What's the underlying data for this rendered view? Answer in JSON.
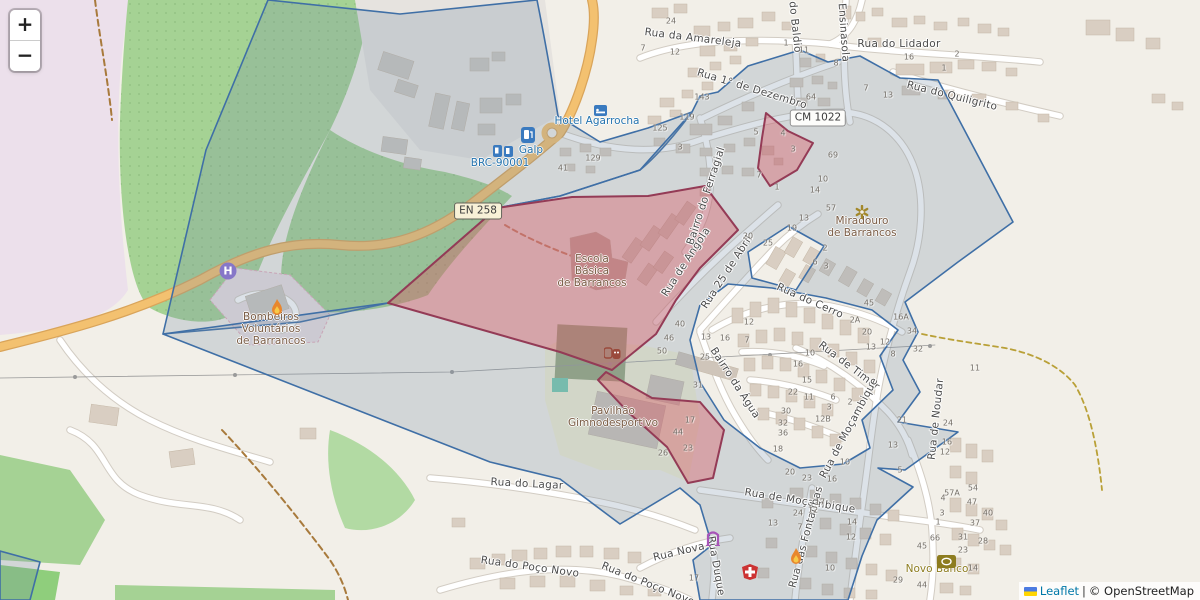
{
  "map": {
    "controls": {
      "zoom_in_label": "+",
      "zoom_out_label": "−"
    },
    "attribution": {
      "leaflet_label": "Leaflet",
      "separator": "|",
      "osm_label": "© OpenStreetMap"
    },
    "road_refs": {
      "en258": "EN 258",
      "cm1022": "CM 1022"
    },
    "icons": {
      "helipad_letter": "H"
    },
    "street_labels": [
      {
        "t": "Rua da Amareleja",
        "x": 693,
        "y": 38,
        "r": 7
      },
      {
        "t": "do Baldio",
        "x": 795,
        "y": 27,
        "r": 84
      },
      {
        "t": "de Ensinasola",
        "x": 843,
        "y": 24,
        "r": 86
      },
      {
        "t": "Rua do Lidador",
        "x": 899,
        "y": 44,
        "r": 0
      },
      {
        "t": "Rua do Quiligrito",
        "x": 952,
        "y": 96,
        "r": 14
      },
      {
        "t": "Rua 1° de Dezembro",
        "x": 752,
        "y": 89,
        "r": 17
      },
      {
        "t": "Bairro do Ferragial",
        "x": 706,
        "y": 196,
        "r": -72
      },
      {
        "t": "Rua de Angola",
        "x": 686,
        "y": 262,
        "r": -57
      },
      {
        "t": "Rua 25 de Abril",
        "x": 727,
        "y": 272,
        "r": -57
      },
      {
        "t": "Rua do Cerro",
        "x": 810,
        "y": 301,
        "r": 24
      },
      {
        "t": "Rua de Timor",
        "x": 849,
        "y": 366,
        "r": 37
      },
      {
        "t": "Bairro da Água",
        "x": 735,
        "y": 383,
        "r": 57
      },
      {
        "t": "Rua de Moçambique",
        "x": 849,
        "y": 428,
        "r": -62
      },
      {
        "t": "Rua de Noudar",
        "x": 936,
        "y": 419,
        "r": -84
      },
      {
        "t": "Rua do Lagar",
        "x": 527,
        "y": 484,
        "r": 3
      },
      {
        "t": "Rua de Moçambique",
        "x": 800,
        "y": 501,
        "r": 9
      },
      {
        "t": "Rua Nova",
        "x": 679,
        "y": 552,
        "r": -13
      },
      {
        "t": "Rua Duque",
        "x": 716,
        "y": 566,
        "r": 80
      },
      {
        "t": "Rua do Poço Novo",
        "x": 530,
        "y": 567,
        "r": 8
      },
      {
        "t": "Rua do Poço Novo",
        "x": 648,
        "y": 584,
        "r": 22
      },
      {
        "t": "Rua das Fontanhas",
        "x": 806,
        "y": 537,
        "r": -75
      }
    ],
    "poi_labels": [
      {
        "t": "Hotel Agarrocha",
        "x": 597,
        "y": 121,
        "cls": "blue"
      },
      {
        "t": "Galp",
        "x": 531,
        "y": 150,
        "cls": "blue"
      },
      {
        "t": "BRC-90001",
        "x": 500,
        "y": 163,
        "cls": "blue"
      },
      {
        "t": "Escola\nBásica\nde Barrancos",
        "x": 592,
        "y": 271,
        "cls": "brown"
      },
      {
        "t": "Miradouro\nde Barrancos",
        "x": 862,
        "y": 227,
        "cls": "brown"
      },
      {
        "t": "Bombeiros\nVoluntários\nde Barrancos",
        "x": 271,
        "y": 329,
        "cls": "brown"
      },
      {
        "t": "Pavilhão\nGimnodesportivo",
        "x": 613,
        "y": 417,
        "cls": "brown"
      },
      {
        "t": "Novo Banco",
        "x": 937,
        "y": 569,
        "cls": "olive"
      }
    ],
    "house_numbers": [
      {
        "t": "24",
        "x": 671,
        "y": 21
      },
      {
        "t": "7",
        "x": 643,
        "y": 48
      },
      {
        "t": "12",
        "x": 675,
        "y": 52
      },
      {
        "t": "1",
        "x": 786,
        "y": 43
      },
      {
        "t": "11",
        "x": 804,
        "y": 50
      },
      {
        "t": "8",
        "x": 836,
        "y": 63
      },
      {
        "t": "16",
        "x": 909,
        "y": 57
      },
      {
        "t": "2",
        "x": 957,
        "y": 54
      },
      {
        "t": "1",
        "x": 944,
        "y": 68
      },
      {
        "t": "7",
        "x": 866,
        "y": 88
      },
      {
        "t": "13",
        "x": 888,
        "y": 95
      },
      {
        "t": "64",
        "x": 811,
        "y": 97
      },
      {
        "t": "143",
        "x": 702,
        "y": 97
      },
      {
        "t": "119",
        "x": 687,
        "y": 117
      },
      {
        "t": "125",
        "x": 660,
        "y": 128
      },
      {
        "t": "129",
        "x": 593,
        "y": 158
      },
      {
        "t": "41",
        "x": 563,
        "y": 168
      },
      {
        "t": "3",
        "x": 680,
        "y": 147
      },
      {
        "t": "5",
        "x": 756,
        "y": 132
      },
      {
        "t": "4",
        "x": 783,
        "y": 133
      },
      {
        "t": "3",
        "x": 793,
        "y": 149
      },
      {
        "t": "7",
        "x": 759,
        "y": 175
      },
      {
        "t": "1",
        "x": 777,
        "y": 187
      },
      {
        "t": "69",
        "x": 833,
        "y": 155
      },
      {
        "t": "10",
        "x": 823,
        "y": 179
      },
      {
        "t": "14",
        "x": 815,
        "y": 190
      },
      {
        "t": "57",
        "x": 831,
        "y": 208
      },
      {
        "t": "13",
        "x": 804,
        "y": 218
      },
      {
        "t": "2",
        "x": 825,
        "y": 248
      },
      {
        "t": "6",
        "x": 815,
        "y": 262
      },
      {
        "t": "3",
        "x": 826,
        "y": 266
      },
      {
        "t": "19",
        "x": 792,
        "y": 228
      },
      {
        "t": "20",
        "x": 748,
        "y": 236
      },
      {
        "t": "25",
        "x": 768,
        "y": 243
      },
      {
        "t": "45",
        "x": 869,
        "y": 303
      },
      {
        "t": "16A",
        "x": 901,
        "y": 317
      },
      {
        "t": "34",
        "x": 912,
        "y": 331
      },
      {
        "t": "2A",
        "x": 855,
        "y": 320
      },
      {
        "t": "20",
        "x": 867,
        "y": 332
      },
      {
        "t": "12",
        "x": 885,
        "y": 342
      },
      {
        "t": "13",
        "x": 871,
        "y": 347
      },
      {
        "t": "8",
        "x": 893,
        "y": 354
      },
      {
        "t": "12",
        "x": 749,
        "y": 322
      },
      {
        "t": "13",
        "x": 706,
        "y": 337
      },
      {
        "t": "16",
        "x": 725,
        "y": 338
      },
      {
        "t": "7",
        "x": 747,
        "y": 340
      },
      {
        "t": "40",
        "x": 680,
        "y": 324
      },
      {
        "t": "46",
        "x": 669,
        "y": 338
      },
      {
        "t": "50",
        "x": 662,
        "y": 351
      },
      {
        "t": "25",
        "x": 705,
        "y": 357
      },
      {
        "t": "31",
        "x": 698,
        "y": 385
      },
      {
        "t": "10",
        "x": 810,
        "y": 353
      },
      {
        "t": "16",
        "x": 798,
        "y": 364
      },
      {
        "t": "15",
        "x": 807,
        "y": 380
      },
      {
        "t": "22",
        "x": 793,
        "y": 392
      },
      {
        "t": "11",
        "x": 809,
        "y": 397
      },
      {
        "t": "30",
        "x": 786,
        "y": 411
      },
      {
        "t": "32",
        "x": 783,
        "y": 423
      },
      {
        "t": "36",
        "x": 783,
        "y": 433
      },
      {
        "t": "18",
        "x": 778,
        "y": 449
      },
      {
        "t": "20",
        "x": 790,
        "y": 472
      },
      {
        "t": "32",
        "x": 918,
        "y": 349
      },
      {
        "t": "11",
        "x": 975,
        "y": 368
      },
      {
        "t": "6",
        "x": 833,
        "y": 397
      },
      {
        "t": "2",
        "x": 850,
        "y": 402
      },
      {
        "t": "3",
        "x": 829,
        "y": 407
      },
      {
        "t": "12B",
        "x": 823,
        "y": 419
      },
      {
        "t": "21",
        "x": 902,
        "y": 420
      },
      {
        "t": "24",
        "x": 948,
        "y": 423
      },
      {
        "t": "13",
        "x": 893,
        "y": 445
      },
      {
        "t": "16",
        "x": 947,
        "y": 442
      },
      {
        "t": "12",
        "x": 945,
        "y": 452
      },
      {
        "t": "5",
        "x": 900,
        "y": 470
      },
      {
        "t": "10",
        "x": 845,
        "y": 462
      },
      {
        "t": "17",
        "x": 690,
        "y": 420
      },
      {
        "t": "44",
        "x": 678,
        "y": 432
      },
      {
        "t": "23",
        "x": 688,
        "y": 448
      },
      {
        "t": "26",
        "x": 663,
        "y": 453
      },
      {
        "t": "23",
        "x": 807,
        "y": 478
      },
      {
        "t": "16",
        "x": 832,
        "y": 479
      },
      {
        "t": "24",
        "x": 798,
        "y": 513
      },
      {
        "t": "17",
        "x": 820,
        "y": 502
      },
      {
        "t": "12",
        "x": 813,
        "y": 510
      },
      {
        "t": "14",
        "x": 852,
        "y": 522
      },
      {
        "t": "12",
        "x": 851,
        "y": 537
      },
      {
        "t": "10",
        "x": 830,
        "y": 568
      },
      {
        "t": "57A",
        "x": 952,
        "y": 493
      },
      {
        "t": "54",
        "x": 973,
        "y": 488
      },
      {
        "t": "47",
        "x": 972,
        "y": 502
      },
      {
        "t": "4",
        "x": 943,
        "y": 498
      },
      {
        "t": "40",
        "x": 988,
        "y": 513
      },
      {
        "t": "3",
        "x": 942,
        "y": 513
      },
      {
        "t": "37",
        "x": 975,
        "y": 523
      },
      {
        "t": "1",
        "x": 938,
        "y": 522
      },
      {
        "t": "66",
        "x": 935,
        "y": 538
      },
      {
        "t": "31",
        "x": 963,
        "y": 537
      },
      {
        "t": "28",
        "x": 983,
        "y": 541
      },
      {
        "t": "45",
        "x": 922,
        "y": 546
      },
      {
        "t": "23",
        "x": 963,
        "y": 550
      },
      {
        "t": "14",
        "x": 973,
        "y": 568
      },
      {
        "t": "29",
        "x": 898,
        "y": 580
      },
      {
        "t": "44",
        "x": 922,
        "y": 585
      },
      {
        "t": "17",
        "x": 694,
        "y": 578
      },
      {
        "t": "13",
        "x": 773,
        "y": 523
      },
      {
        "t": "7",
        "x": 800,
        "y": 527
      }
    ]
  }
}
